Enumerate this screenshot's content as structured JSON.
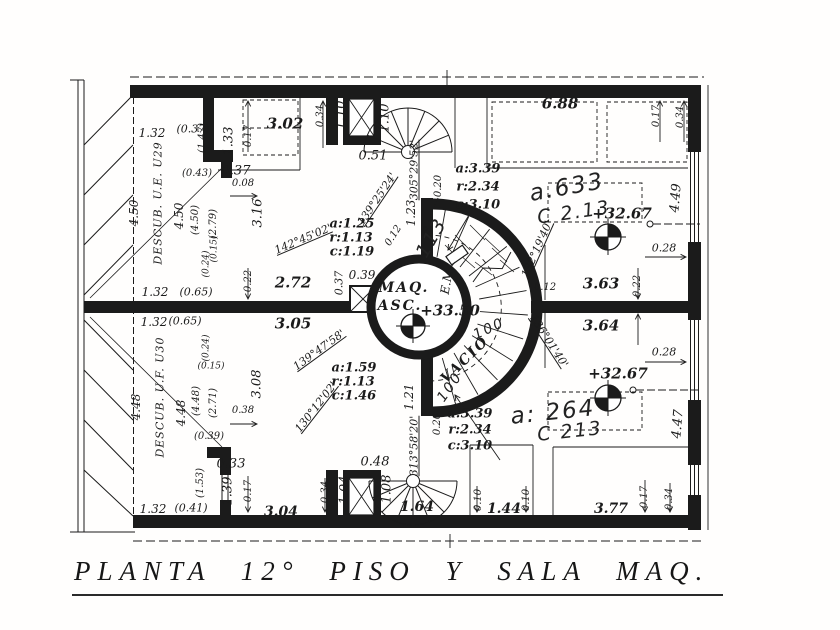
{
  "title": {
    "text": "PLANTA 12° PISO Y SALA MAQ."
  },
  "plan": {
    "ink_color": "#1b1b1b",
    "labels": [
      {
        "t": "1.32",
        "x": 152,
        "y": 133,
        "s": 12
      },
      {
        "t": "(0.37)",
        "x": 193,
        "y": 129,
        "s": 11
      },
      {
        "t": "1.33",
        "x": 229,
        "y": 141,
        "r": -90,
        "s": 13
      },
      {
        "t": "0.17",
        "x": 249,
        "y": 136,
        "r": -90,
        "s": 10
      },
      {
        "t": "3.02",
        "x": 285,
        "y": 124,
        "s": 15,
        "cls": "room",
        "n": "room-area-label"
      },
      {
        "t": "(1.47)",
        "x": 203,
        "y": 138,
        "r": -90,
        "s": 10
      },
      {
        "t": "0.34",
        "x": 321,
        "y": 116,
        "r": -90,
        "s": 10
      },
      {
        "t": "1.10",
        "x": 341,
        "y": 115,
        "r": -90,
        "s": 13
      },
      {
        "t": "1.10",
        "x": 385,
        "y": 118,
        "r": -90,
        "s": 13
      },
      {
        "t": "0.37",
        "x": 236,
        "y": 171,
        "s": 13
      },
      {
        "t": "0.51",
        "x": 373,
        "y": 156,
        "s": 13
      },
      {
        "t": "(0.43)",
        "x": 197,
        "y": 174,
        "s": 10
      },
      {
        "t": "0.08",
        "x": 243,
        "y": 184,
        "s": 10
      },
      {
        "t": "3.16",
        "x": 258,
        "y": 213,
        "r": -90,
        "s": 13
      },
      {
        "t": "6.88",
        "x": 560,
        "y": 104,
        "s": 15,
        "cls": "room",
        "n": "room-area-label"
      },
      {
        "t": "0.17",
        "x": 657,
        "y": 116,
        "r": -90,
        "s": 10
      },
      {
        "t": "0.34",
        "x": 681,
        "y": 117,
        "r": -90,
        "s": 10
      },
      {
        "t": "4.49",
        "x": 676,
        "y": 198,
        "r": -85,
        "s": 13
      },
      {
        "t": "4.50",
        "x": 134,
        "y": 213,
        "r": -90,
        "s": 12
      },
      {
        "t": "DESCUB. U.E. U29",
        "x": 158,
        "y": 203,
        "r": -90,
        "s": 11,
        "cls": "name",
        "n": "zone-label"
      },
      {
        "t": "4.50",
        "x": 179,
        "y": 216,
        "r": -90,
        "s": 12
      },
      {
        "t": "(4.50)",
        "x": 196,
        "y": 220,
        "r": -90,
        "s": 10
      },
      {
        "t": "(2.79)",
        "x": 214,
        "y": 224,
        "r": -90,
        "s": 10
      },
      {
        "t": "(0.15)",
        "x": 215,
        "y": 249,
        "r": -90,
        "s": 9
      },
      {
        "t": "(0.24)",
        "x": 207,
        "y": 264,
        "r": -90,
        "s": 9
      },
      {
        "t": "1.32",
        "x": 155,
        "y": 292,
        "s": 12
      },
      {
        "t": "(0.65)",
        "x": 196,
        "y": 292,
        "s": 11
      },
      {
        "t": "1.32",
        "x": 154,
        "y": 322,
        "s": 12
      },
      {
        "t": "(0.65)",
        "x": 185,
        "y": 321,
        "s": 11
      },
      {
        "t": "(0.24)",
        "x": 207,
        "y": 348,
        "r": -90,
        "s": 9
      },
      {
        "t": "(0.15)",
        "x": 211,
        "y": 367,
        "s": 9
      },
      {
        "t": "4.48",
        "x": 136,
        "y": 407,
        "r": -90,
        "s": 12
      },
      {
        "t": "DESCUB. U.F. U30",
        "x": 160,
        "y": 397,
        "r": -90,
        "s": 11,
        "cls": "name",
        "n": "zone-label"
      },
      {
        "t": "4.48",
        "x": 181,
        "y": 413,
        "r": -90,
        "s": 12
      },
      {
        "t": "(4.48)",
        "x": 197,
        "y": 401,
        "r": -90,
        "s": 10
      },
      {
        "t": "(2.71)",
        "x": 214,
        "y": 403,
        "r": -90,
        "s": 10
      },
      {
        "t": "(0.39)",
        "x": 209,
        "y": 437,
        "s": 10
      },
      {
        "t": "(1.53)",
        "x": 201,
        "y": 483,
        "r": -90,
        "s": 10
      },
      {
        "t": "1.32",
        "x": 153,
        "y": 509,
        "s": 12
      },
      {
        "t": "(0.41)",
        "x": 191,
        "y": 508,
        "s": 11
      },
      {
        "t": "0.22",
        "x": 249,
        "y": 281,
        "r": -90,
        "s": 10
      },
      {
        "t": "2.72",
        "x": 293,
        "y": 283,
        "s": 15,
        "cls": "room",
        "n": "room-area-label"
      },
      {
        "t": "3.05",
        "x": 293,
        "y": 324,
        "s": 15,
        "cls": "room",
        "n": "room-area-label"
      },
      {
        "t": "0.37",
        "x": 339,
        "y": 283,
        "r": -90,
        "s": 11
      },
      {
        "t": "0.39",
        "x": 362,
        "y": 275,
        "s": 12
      },
      {
        "t": "3.08",
        "x": 257,
        "y": 384,
        "r": -90,
        "s": 13
      },
      {
        "t": "0.38",
        "x": 243,
        "y": 411,
        "s": 10
      },
      {
        "t": "142°45'02'",
        "x": 303,
        "y": 239,
        "r": -23,
        "s": 11,
        "cls": "angle",
        "n": "angle-label"
      },
      {
        "t": "a:1.25",
        "x": 352,
        "y": 224,
        "s": 13,
        "cls": "arc"
      },
      {
        "t": "r:1.13",
        "x": 351,
        "y": 238,
        "s": 13,
        "cls": "arc"
      },
      {
        "t": "c:1.19",
        "x": 352,
        "y": 252,
        "s": 13,
        "cls": "arc"
      },
      {
        "t": "139°25'24'",
        "x": 377,
        "y": 199,
        "r": -56,
        "s": 11,
        "cls": "angle",
        "n": "angle-label"
      },
      {
        "t": "305°29'52'",
        "x": 414,
        "y": 170,
        "r": -90,
        "s": 11,
        "cls": "angle",
        "n": "angle-label"
      },
      {
        "t": "1.23",
        "x": 411,
        "y": 213,
        "r": -90,
        "s": 12
      },
      {
        "t": "0.20",
        "x": 439,
        "y": 186,
        "r": -90,
        "s": 10
      },
      {
        "t": "0.12",
        "x": 394,
        "y": 236,
        "r": -58,
        "s": 10
      },
      {
        "t": "a:3.39",
        "x": 478,
        "y": 169,
        "s": 13,
        "cls": "arc"
      },
      {
        "t": "r:2.34",
        "x": 478,
        "y": 187,
        "s": 13,
        "cls": "arc"
      },
      {
        "t": "c:3.10",
        "x": 478,
        "y": 205,
        "s": 13,
        "cls": "arc"
      },
      {
        "t": "MAQ.",
        "x": 404,
        "y": 288,
        "s": 14,
        "cls": "name2",
        "n": "machine-room-label"
      },
      {
        "t": "ASC.",
        "x": 400,
        "y": 306,
        "s": 14,
        "cls": "name2",
        "n": "machine-room-label"
      },
      {
        "t": "+33.50",
        "x": 450,
        "y": 311,
        "s": 15,
        "cls": "level",
        "n": "level-marker-label"
      },
      {
        "t": "E.M.",
        "x": 447,
        "y": 280,
        "r": -80,
        "s": 12
      },
      {
        "t": "VACIO",
        "x": 465,
        "y": 360,
        "r": -44,
        "s": 14,
        "cls": "name2",
        "n": "void-label"
      },
      {
        "t": "132°19'40'",
        "x": 537,
        "y": 249,
        "r": -66,
        "s": 11,
        "cls": "angle",
        "n": "angle-label"
      },
      {
        "t": "0.12",
        "x": 545,
        "y": 288,
        "s": 10
      },
      {
        "t": "136°01'40'",
        "x": 549,
        "y": 341,
        "r": 57,
        "s": 11,
        "cls": "angle",
        "n": "angle-label"
      },
      {
        "t": "3.63",
        "x": 601,
        "y": 284,
        "s": 15,
        "cls": "room",
        "n": "room-area-label"
      },
      {
        "t": "3.64",
        "x": 601,
        "y": 326,
        "s": 15,
        "cls": "room",
        "n": "room-area-label"
      },
      {
        "t": "0.22",
        "x": 638,
        "y": 286,
        "r": -90,
        "s": 10
      },
      {
        "t": "+32.67",
        "x": 622,
        "y": 214,
        "s": 15,
        "cls": "level",
        "n": "level-marker-label"
      },
      {
        "t": "0.28",
        "x": 664,
        "y": 248,
        "s": 11
      },
      {
        "t": "+32.67",
        "x": 618,
        "y": 374,
        "s": 15,
        "cls": "level",
        "n": "level-marker-label"
      },
      {
        "t": "0.28",
        "x": 664,
        "y": 352,
        "s": 11
      },
      {
        "t": "4.47",
        "x": 678,
        "y": 424,
        "r": -85,
        "s": 13
      },
      {
        "t": "139°47'58'",
        "x": 319,
        "y": 350,
        "r": -36,
        "s": 11,
        "cls": "angle",
        "n": "angle-label"
      },
      {
        "t": "a:1.59",
        "x": 354,
        "y": 368,
        "s": 13,
        "cls": "arc"
      },
      {
        "t": "r:1.13",
        "x": 353,
        "y": 382,
        "s": 13,
        "cls": "arc"
      },
      {
        "t": "c:1.46",
        "x": 354,
        "y": 396,
        "s": 13,
        "cls": "arc"
      },
      {
        "t": "130°12'02'",
        "x": 316,
        "y": 407,
        "r": -52,
        "s": 11,
        "cls": "angle",
        "n": "angle-label"
      },
      {
        "t": "1.21",
        "x": 409,
        "y": 397,
        "r": -90,
        "s": 12
      },
      {
        "t": "313°58'20'",
        "x": 414,
        "y": 446,
        "r": -90,
        "s": 11,
        "cls": "angle",
        "n": "angle-label"
      },
      {
        "t": "0.20",
        "x": 438,
        "y": 424,
        "r": -90,
        "s": 10
      },
      {
        "t": "a:3.39",
        "x": 470,
        "y": 414,
        "s": 13,
        "cls": "arc"
      },
      {
        "t": "r:2.34",
        "x": 470,
        "y": 430,
        "s": 13,
        "cls": "arc"
      },
      {
        "t": "c:3.10",
        "x": 470,
        "y": 446,
        "s": 13,
        "cls": "arc"
      },
      {
        "t": "0.33",
        "x": 231,
        "y": 464,
        "s": 13
      },
      {
        "t": "1.39",
        "x": 228,
        "y": 491,
        "r": -90,
        "s": 13
      },
      {
        "t": "0.17",
        "x": 249,
        "y": 491,
        "r": -90,
        "s": 10
      },
      {
        "t": "3.04",
        "x": 281,
        "y": 512,
        "s": 14,
        "cls": "room",
        "n": "room-area-label"
      },
      {
        "t": "0.34",
        "x": 326,
        "y": 492,
        "r": -90,
        "s": 10
      },
      {
        "t": "1.04",
        "x": 345,
        "y": 490,
        "r": -90,
        "s": 13
      },
      {
        "t": "0.48",
        "x": 375,
        "y": 462,
        "s": 13
      },
      {
        "t": "1.08",
        "x": 387,
        "y": 489,
        "r": -90,
        "s": 13
      },
      {
        "t": "1.64",
        "x": 417,
        "y": 507,
        "s": 14,
        "cls": "room",
        "n": "room-area-label"
      },
      {
        "t": "0.10",
        "x": 479,
        "y": 500,
        "r": -90,
        "s": 10
      },
      {
        "t": "1.44",
        "x": 504,
        "y": 509,
        "s": 14,
        "cls": "room",
        "n": "room-area-label"
      },
      {
        "t": "0.10",
        "x": 527,
        "y": 500,
        "r": -90,
        "s": 10
      },
      {
        "t": "3.77",
        "x": 611,
        "y": 509,
        "s": 14,
        "cls": "room",
        "n": "room-area-label"
      },
      {
        "t": "0.17",
        "x": 645,
        "y": 497,
        "r": -90,
        "s": 10
      },
      {
        "t": "0.34",
        "x": 670,
        "y": 499,
        "r": -90,
        "s": 10
      },
      {
        "t": "a.633",
        "x": 567,
        "y": 188,
        "r": -10,
        "s": 23,
        "cls": "hand",
        "n": "handwritten-note"
      },
      {
        "t": "C 2.13",
        "x": 574,
        "y": 213,
        "r": -8,
        "s": 19,
        "cls": "hand",
        "n": "handwritten-note"
      },
      {
        "t": "a: 264",
        "x": 553,
        "y": 413,
        "r": -6,
        "s": 23,
        "cls": "hand",
        "n": "handwritten-note"
      },
      {
        "t": "C 213",
        "x": 570,
        "y": 432,
        "r": -6,
        "s": 19,
        "cls": "hand",
        "n": "handwritten-note"
      },
      {
        "t": "113",
        "x": 432,
        "y": 238,
        "r": -60,
        "s": 19,
        "cls": "hand",
        "n": "handwritten-note"
      },
      {
        "t": "100",
        "x": 489,
        "y": 329,
        "r": -25,
        "s": 14,
        "cls": "hand",
        "n": "handwritten-note"
      },
      {
        "t": "100",
        "x": 450,
        "y": 387,
        "r": -55,
        "s": 14,
        "cls": "hand",
        "n": "handwritten-note"
      }
    ]
  }
}
